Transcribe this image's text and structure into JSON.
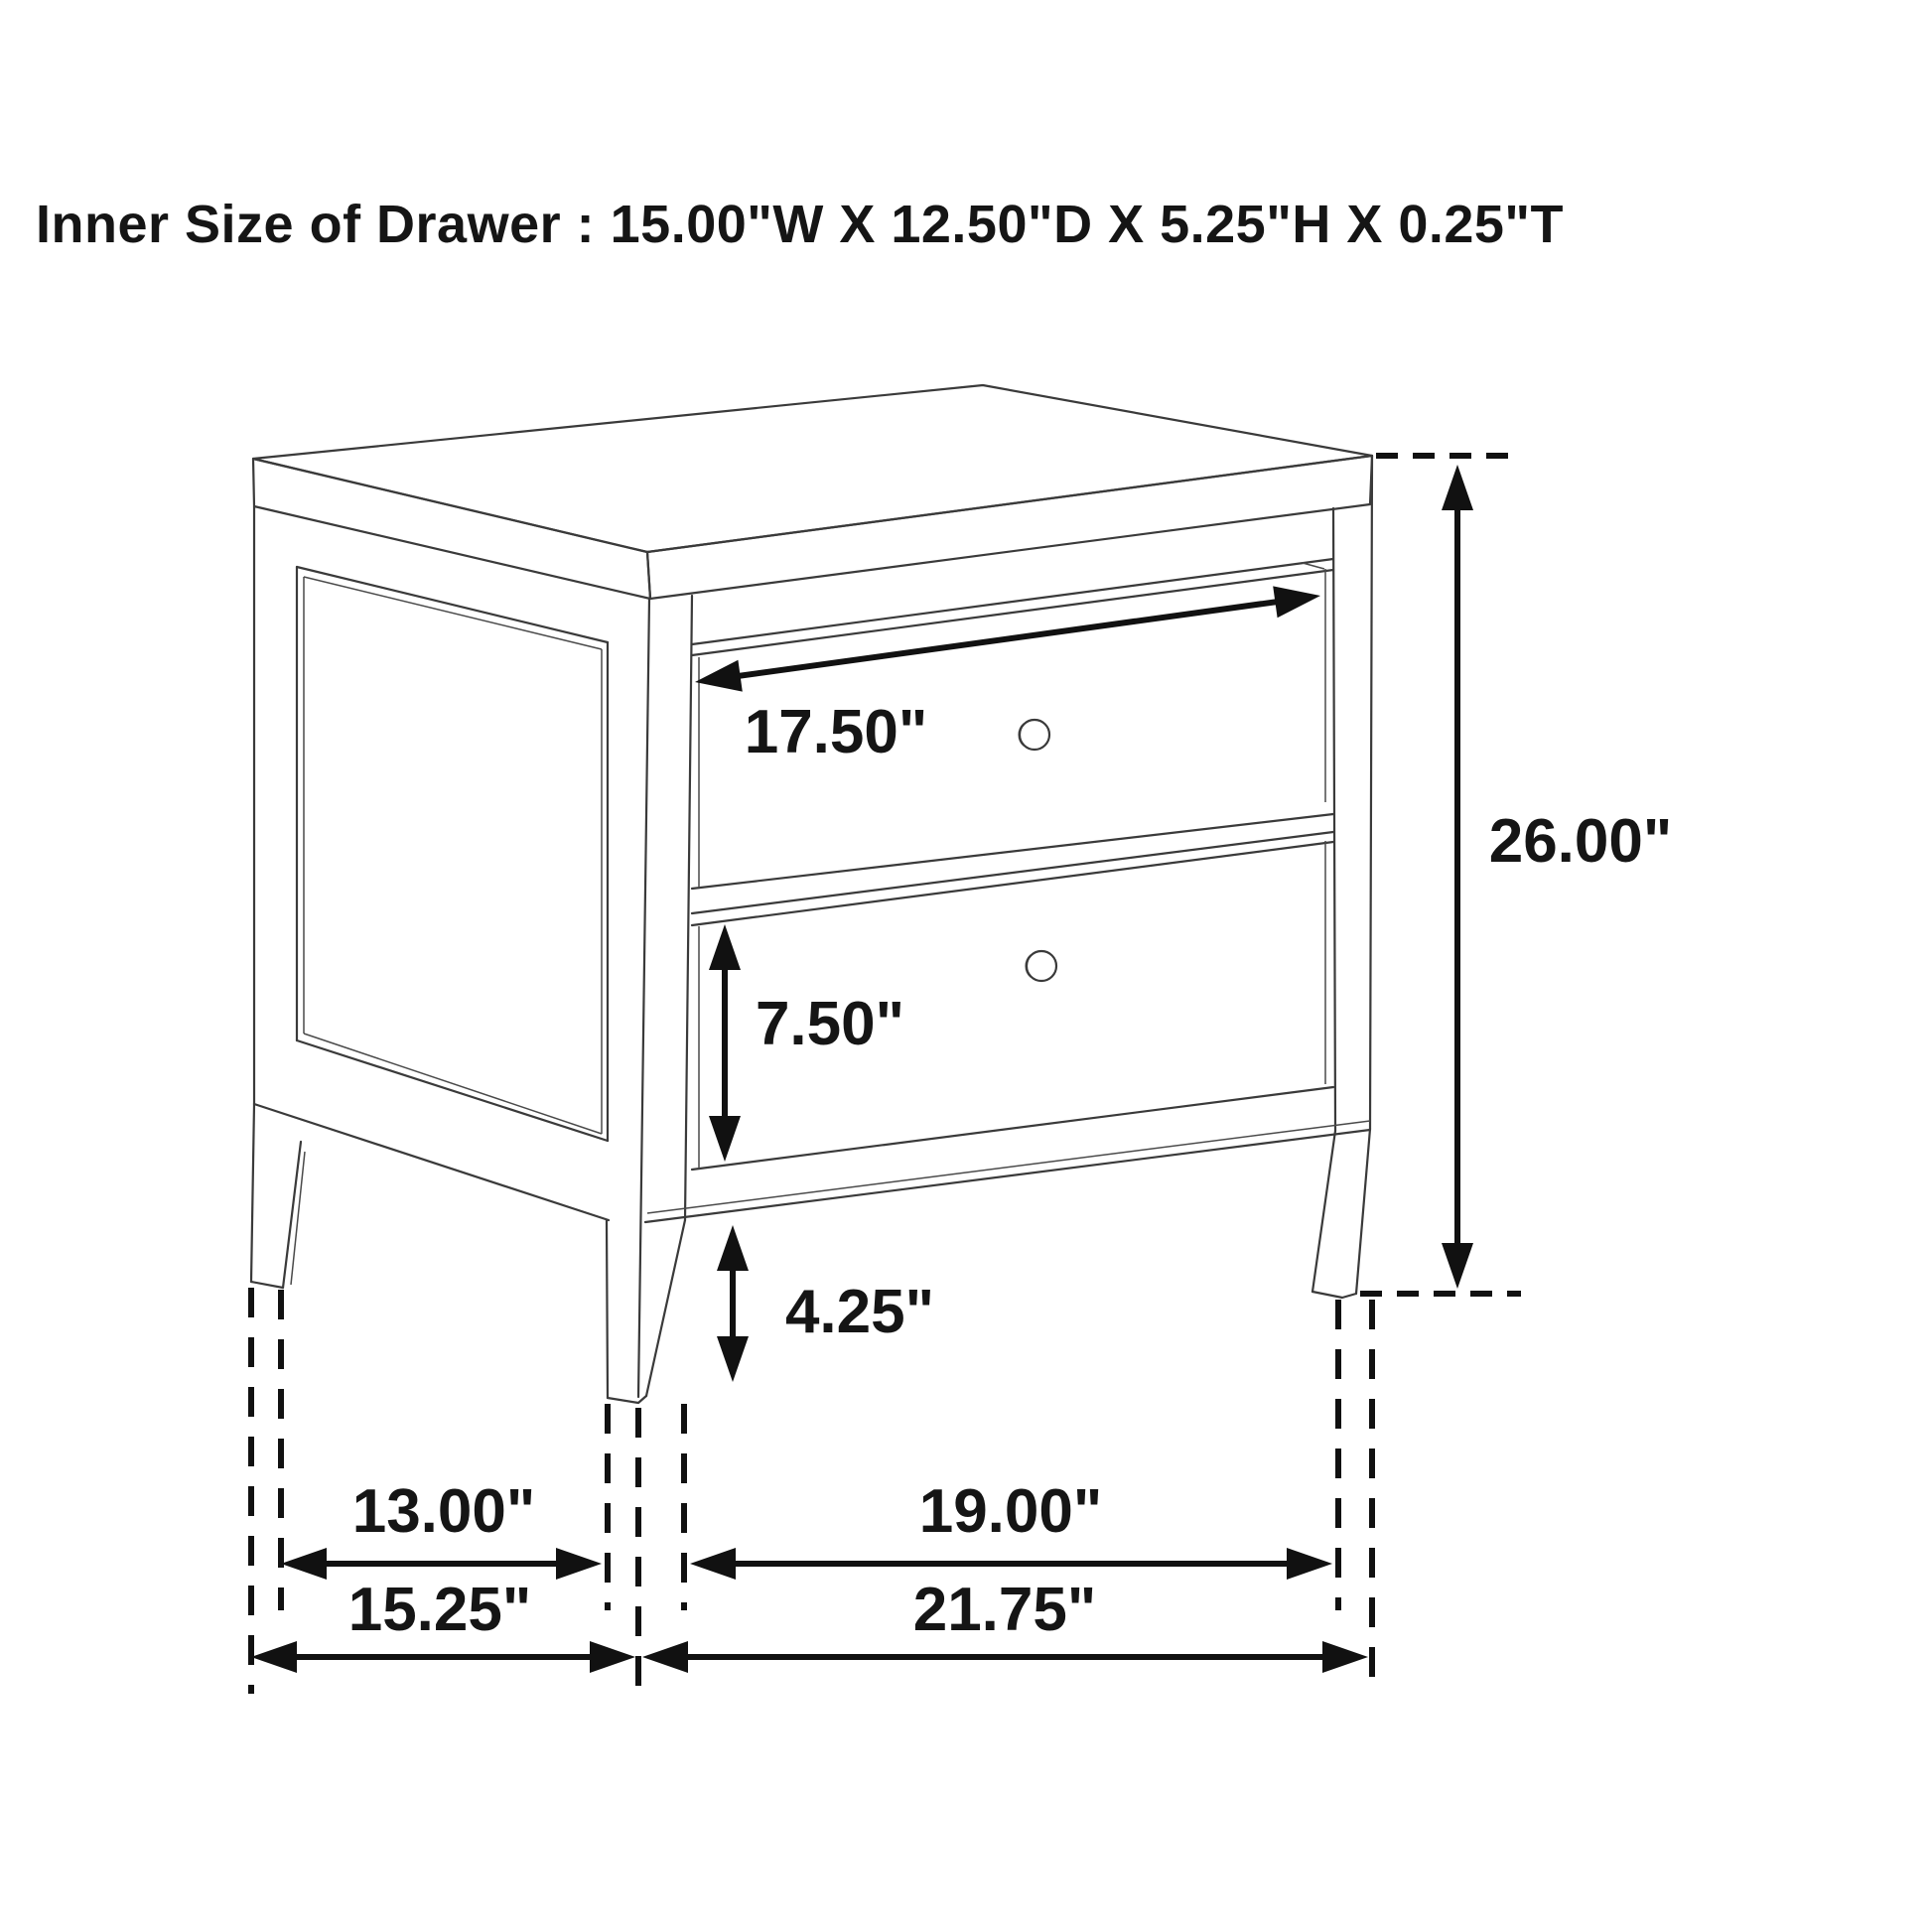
{
  "title": "Inner Size of Drawer : 15.00\"W X 12.50\"D X 5.25\"H X 0.25\"T",
  "diagram": {
    "type": "furniture-dimension-diagram",
    "subject": "two-drawer nightstand line drawing",
    "inner_drawer_size": {
      "width": "15.00\"W",
      "depth": "12.50\"D",
      "height": "5.25\"H",
      "thickness": "0.25\"T"
    },
    "dimensions": {
      "drawer_face_width": "17.50\"",
      "overall_height": "26.00\"",
      "lower_drawer_height": "7.50\"",
      "leg_clearance": "4.25\"",
      "side_inner_span": "13.00\"",
      "side_overall_depth": "15.25\"",
      "front_inner_span": "19.00\"",
      "front_overall_width": "21.75\""
    },
    "colors": {
      "background": "#ffffff",
      "drawing_line": "#3a3a3a",
      "annotation": "#111111"
    }
  }
}
